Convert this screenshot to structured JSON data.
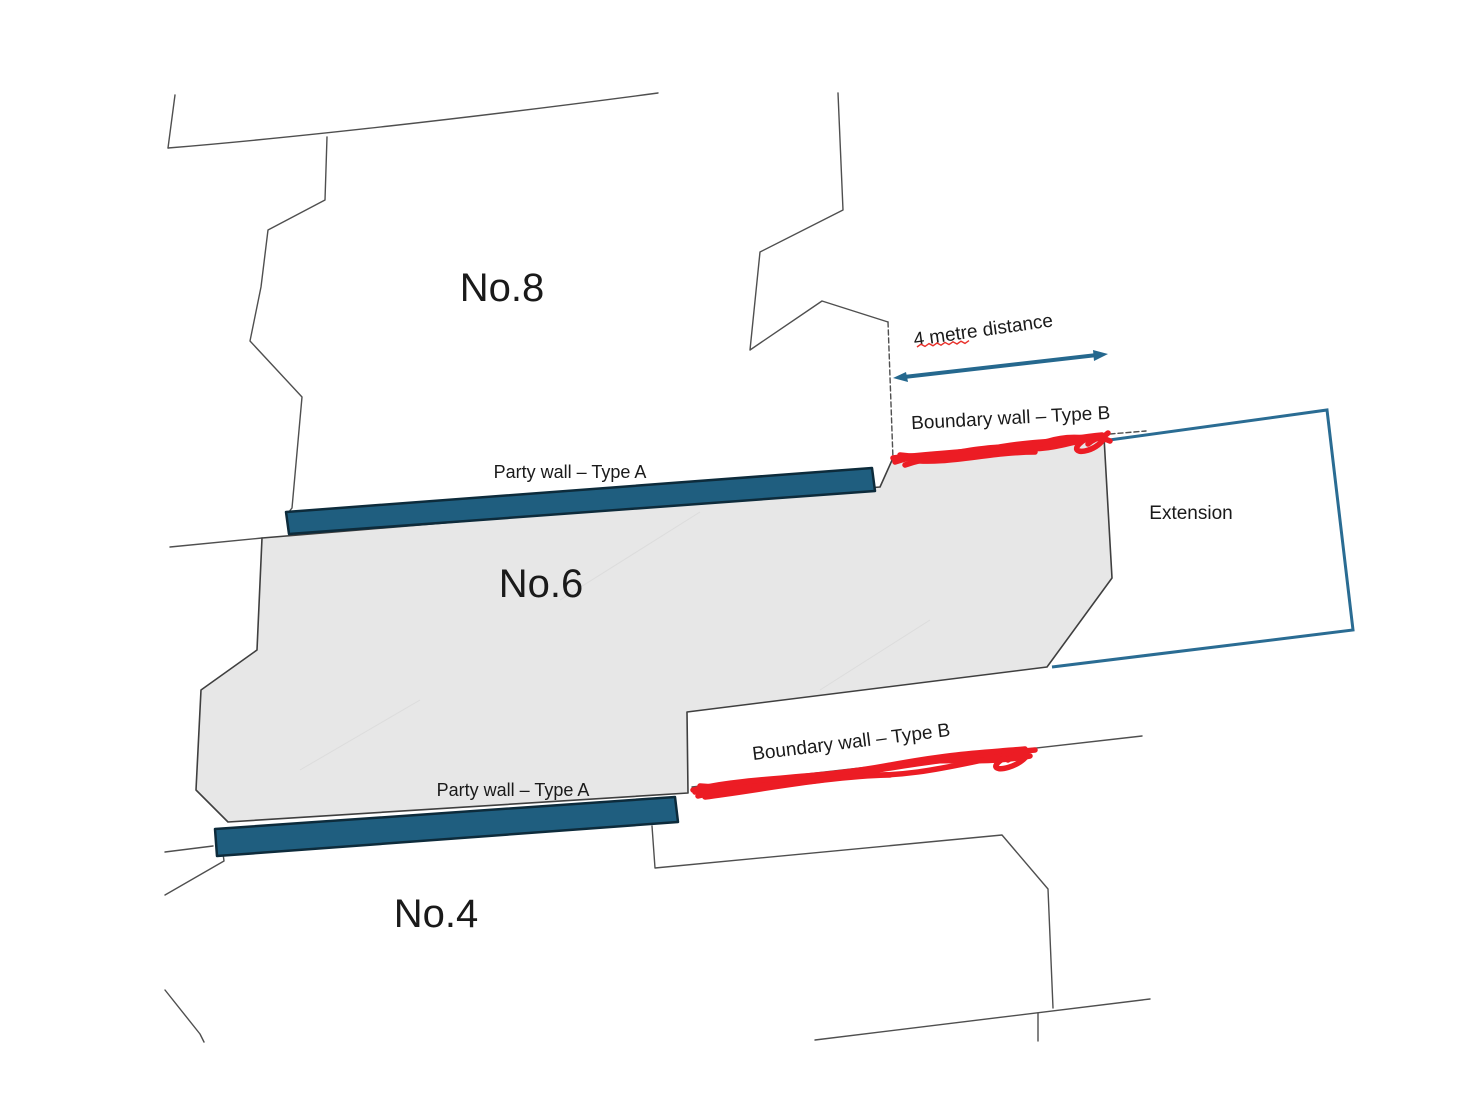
{
  "houses": {
    "no8": "No.8",
    "no6": "No.6",
    "no4": "No.4"
  },
  "walls": {
    "party_wall_top": "Party wall – Type A",
    "party_wall_bottom": "Party wall – Type A",
    "boundary_wall_top": "Boundary wall – Type B",
    "boundary_wall_bottom": "Boundary wall – Type B"
  },
  "annotations": {
    "distance": "4 metre distance",
    "extension": "Extension"
  },
  "colors": {
    "party_wall_fill": "#1f5e7f",
    "party_wall_edge": "#0d2b3b",
    "teal_accent": "#25688e",
    "extension_outline": "#2a6c93",
    "boundary_marker_red": "#ec1c24",
    "house_fill": "#e7e7e7",
    "plot_line": "#4f4f4f",
    "text": "#1a1a1a",
    "background": "#ffffff"
  }
}
